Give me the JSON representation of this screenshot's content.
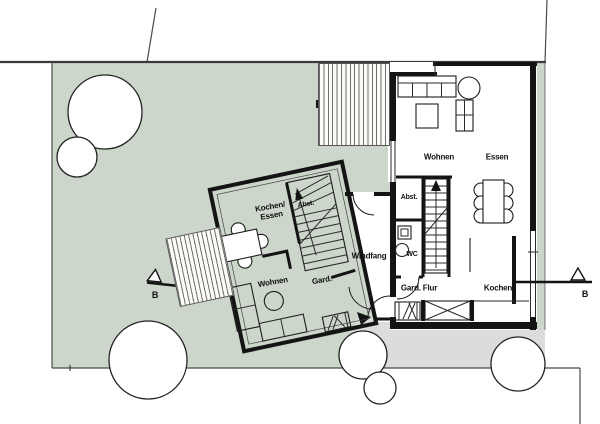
{
  "plan": {
    "title": "site floor plan",
    "colors": {
      "garden": "#ccd6ca",
      "paving": "#dcdcdc",
      "wall": "#141414"
    },
    "house_tilted": {
      "rooms": {
        "kochen_essen": "Kochen/\nEssen",
        "abst": "Abst.",
        "wohnen": "Wohnen",
        "gard": "Gard."
      }
    },
    "vestibule": {
      "label": "Windfang"
    },
    "house_right": {
      "rooms": {
        "wohnen": "Wohnen",
        "essen": "Essen",
        "abst": "Abst.",
        "wc": "WC",
        "gard_flur": "Gard. Flur",
        "kochen": "Kochen"
      }
    },
    "section_markers": {
      "left": "B",
      "right": "B"
    }
  }
}
